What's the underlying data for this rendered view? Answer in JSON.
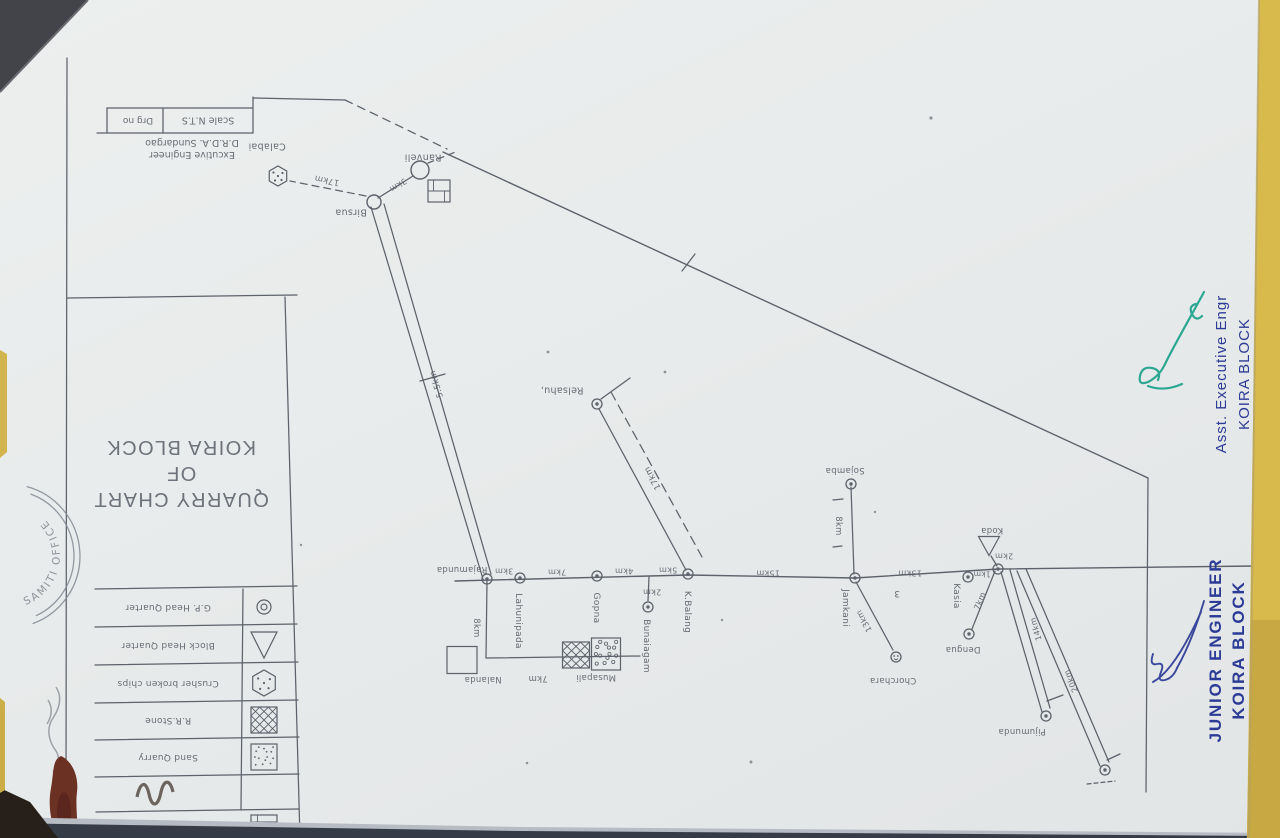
{
  "document": {
    "title_line1": "QUARRY CHART",
    "title_line2": "OF",
    "title_line3": "KOIRA BLOCK"
  },
  "title_block": {
    "scale": "Scale N.T.S",
    "drg_no": "Drg no",
    "engineer_line1": "Excutive Engineer",
    "engineer_line2": "D.R.D.A. Sundargao"
  },
  "signatures": {
    "asst_title": "Asst. Executive Engr",
    "asst_org": "KOIRA BLOCK",
    "junior_title": "JUNIOR ENGINEER",
    "junior_org": "KOIRA BLOCK"
  },
  "stamp": {
    "text": "SAMITI OFFICE"
  },
  "colors": {
    "pencil": "#5d626b",
    "blue_ink": "#2c3b96",
    "green_ink": "#17a089",
    "paper": "#e8ebeb",
    "background_yellow": "#d7b94c"
  },
  "legend": {
    "rows": [
      {
        "label": "G.P. Head Quarter",
        "symbol": "ring"
      },
      {
        "label": "Block Head Quarter",
        "symbol": "tri"
      },
      {
        "label": "Crusher broken chips",
        "symbol": "hex"
      },
      {
        "label": "R.R.Stone",
        "symbol": "hatch"
      },
      {
        "label": "Sand Quarry",
        "symbol": "stip"
      },
      {
        "label": "",
        "symbol": "brick"
      }
    ]
  },
  "drawing": {
    "edges": [
      {
        "n": "titleblock-top",
        "pts": [
          [
            107,
            108
          ],
          [
            253,
            108
          ]
        ]
      },
      {
        "n": "titleblock-bottom",
        "pts": [
          [
            97,
            133
          ],
          [
            253,
            133
          ]
        ]
      },
      {
        "n": "titleblock-left-divider",
        "pts": [
          [
            107,
            108
          ],
          [
            107,
            133
          ]
        ]
      },
      {
        "n": "titleblock-divider",
        "pts": [
          [
            163,
            108
          ],
          [
            163,
            133
          ]
        ]
      },
      {
        "n": "titleblock-right",
        "pts": [
          [
            253,
            97
          ],
          [
            253,
            133
          ]
        ]
      },
      {
        "n": "titleblock-topline",
        "pts": [
          [
            253,
            98
          ],
          [
            345,
            100
          ]
        ]
      },
      {
        "n": "leader-dashed",
        "pts": [
          [
            345,
            100
          ],
          [
            447,
            149
          ]
        ],
        "dash": "8 6"
      },
      {
        "n": "frame-left",
        "pts": [
          [
            67,
            58
          ],
          [
            66,
            795
          ]
        ]
      },
      {
        "n": "panel-top",
        "pts": [
          [
            67,
            298
          ],
          [
            297,
            295
          ]
        ]
      },
      {
        "n": "panel-right",
        "pts": [
          [
            285,
            297
          ],
          [
            300,
            838
          ]
        ]
      },
      {
        "n": "legend-line",
        "pts": [
          [
            95,
            589
          ],
          [
            297,
            586
          ]
        ]
      },
      {
        "n": "legend-line",
        "pts": [
          [
            95,
            627
          ],
          [
            297,
            624
          ]
        ]
      },
      {
        "n": "legend-line",
        "pts": [
          [
            95,
            665
          ],
          [
            298,
            662
          ]
        ]
      },
      {
        "n": "legend-line",
        "pts": [
          [
            95,
            703
          ],
          [
            298,
            700
          ]
        ]
      },
      {
        "n": "legend-line",
        "pts": [
          [
            95,
            740
          ],
          [
            299,
            737
          ]
        ]
      },
      {
        "n": "legend-line",
        "pts": [
          [
            95,
            777
          ],
          [
            299,
            774
          ]
        ]
      },
      {
        "n": "legend-line",
        "pts": [
          [
            96,
            812
          ],
          [
            299,
            809
          ]
        ]
      },
      {
        "n": "legend-divider",
        "pts": [
          [
            243,
            589
          ],
          [
            241,
            810
          ]
        ]
      },
      {
        "n": "road-main",
        "pts": [
          [
            455,
            581
          ],
          [
            688,
            575
          ],
          [
            855,
            578
          ],
          [
            998,
            569
          ],
          [
            1256,
            566
          ]
        ],
        "w": 1.4
      },
      {
        "n": "road-rajamunda-south",
        "pts": [
          [
            487,
            581
          ],
          [
            486,
            658
          ]
        ]
      },
      {
        "n": "road-bottom",
        "pts": [
          [
            486,
            658
          ],
          [
            640,
            656
          ]
        ]
      },
      {
        "n": "road-branch-bunaiagam",
        "pts": [
          [
            649,
            577
          ],
          [
            648,
            601
          ]
        ]
      },
      {
        "n": "road-kbalang-relsahu",
        "pts": [
          [
            686,
            570
          ],
          [
            599,
            409
          ]
        ]
      },
      {
        "n": "trail-relsahu-dashed",
        "pts": [
          [
            611,
            392
          ],
          [
            702,
            557
          ]
        ],
        "dash": "9 6"
      },
      {
        "n": "relsahu-tick",
        "pts": [
          [
            601,
            399
          ],
          [
            630,
            378
          ]
        ]
      },
      {
        "n": "road-birsua-ranveli",
        "pts": [
          [
            378,
            198
          ],
          [
            413,
            176
          ]
        ]
      },
      {
        "n": "trail-ranveli-dashed",
        "pts": [
          [
            428,
            163
          ],
          [
            458,
            151
          ]
        ],
        "dash": "6 5"
      },
      {
        "n": "trail-calabai-dashed",
        "pts": [
          [
            366,
            196
          ],
          [
            290,
            181
          ]
        ],
        "dash": "7 5"
      },
      {
        "n": "road-pair-a",
        "pts": [
          [
            371,
            207
          ],
          [
            483,
            579
          ]
        ]
      },
      {
        "n": "road-pair-b",
        "pts": [
          [
            384,
            204
          ],
          [
            491,
            574
          ]
        ]
      },
      {
        "n": "road-pair-tick",
        "pts": [
          [
            420,
            381
          ],
          [
            445,
            374
          ]
        ]
      },
      {
        "n": "boundary-diagonal",
        "pts": [
          [
            443,
            152
          ],
          [
            1148,
            478
          ]
        ],
        "w": 1.4
      },
      {
        "n": "boundary-tick",
        "pts": [
          [
            682,
            271
          ],
          [
            695,
            254
          ]
        ]
      },
      {
        "n": "frame-right",
        "pts": [
          [
            1148,
            478
          ],
          [
            1146,
            792
          ]
        ]
      },
      {
        "n": "road-sojamba",
        "pts": [
          [
            851,
            487
          ],
          [
            854,
            574
          ]
        ]
      },
      {
        "n": "sojamba-dash",
        "pts": [
          [
            833,
            500
          ],
          [
            843,
            499
          ]
        ]
      },
      {
        "n": "sojamba-dash",
        "pts": [
          [
            833,
            547
          ],
          [
            842,
            546
          ]
        ]
      },
      {
        "n": "road-jamkani-chorchara",
        "pts": [
          [
            856,
            582
          ],
          [
            893,
            650
          ]
        ]
      },
      {
        "n": "koida-link",
        "pts": [
          [
            991,
            556
          ],
          [
            997,
            566
          ]
        ]
      },
      {
        "n": "road-koida-dengua",
        "pts": [
          [
            995,
            571
          ],
          [
            972,
            629
          ]
        ]
      },
      {
        "n": "road-koida-pijumunda-a",
        "pts": [
          [
            1001,
            572
          ],
          [
            1042,
            712
          ]
        ]
      },
      {
        "n": "road-koida-pijumunda-b",
        "pts": [
          [
            1010,
            570
          ],
          [
            1050,
            708
          ]
        ]
      },
      {
        "n": "pijumunda-tick",
        "pts": [
          [
            1047,
            701
          ],
          [
            1063,
            695
          ]
        ]
      },
      {
        "n": "road-koida-south-a",
        "pts": [
          [
            1017,
            571
          ],
          [
            1100,
            766
          ]
        ]
      },
      {
        "n": "road-koida-south-b",
        "pts": [
          [
            1026,
            569
          ],
          [
            1109,
            762
          ]
        ]
      },
      {
        "n": "terminal-tick",
        "pts": [
          [
            1107,
            760
          ],
          [
            1120,
            754
          ]
        ]
      },
      {
        "n": "terminal-dash",
        "pts": [
          [
            1087,
            784
          ],
          [
            1115,
            781
          ]
        ],
        "dash": "4 3"
      }
    ],
    "nodes": [
      {
        "id": "rajamunda",
        "x": 487,
        "y": 579,
        "t": "double"
      },
      {
        "id": "lahunipada",
        "x": 520,
        "y": 578,
        "t": "double"
      },
      {
        "id": "gopna",
        "x": 597,
        "y": 576,
        "t": "double"
      },
      {
        "id": "bunaiagam",
        "x": 648,
        "y": 607,
        "t": "double"
      },
      {
        "id": "kbalang",
        "x": 688,
        "y": 574,
        "t": "double"
      },
      {
        "id": "relsahu",
        "x": 597,
        "y": 404,
        "t": "double"
      },
      {
        "id": "sojamba",
        "x": 851,
        "y": 484,
        "t": "double"
      },
      {
        "id": "jamkani",
        "x": 855,
        "y": 578,
        "t": "double"
      },
      {
        "id": "chorchara",
        "x": 896,
        "y": 657,
        "t": "dots"
      },
      {
        "id": "kasia",
        "x": 968,
        "y": 577,
        "t": "double"
      },
      {
        "id": "koida-junction",
        "x": 998,
        "y": 569,
        "t": "double"
      },
      {
        "id": "dengua",
        "x": 969,
        "y": 634,
        "t": "double"
      },
      {
        "id": "pijumunda",
        "x": 1046,
        "y": 716,
        "t": "double"
      },
      {
        "id": "terminal-20km",
        "x": 1105,
        "y": 770,
        "t": "double"
      },
      {
        "id": "ranveli",
        "x": 420,
        "y": 170,
        "t": "circle",
        "r": 9
      },
      {
        "id": "birsua",
        "x": 374,
        "y": 202,
        "t": "circle",
        "r": 7
      }
    ],
    "symbols": [
      {
        "t": "brick",
        "x": 439,
        "y": 191,
        "w": 22,
        "h": 22,
        "n": "quarry-symbol-ranveli"
      },
      {
        "t": "hex",
        "x": 278,
        "y": 176,
        "w": 20,
        "n": "crusher-symbol-calabai"
      },
      {
        "t": "tri",
        "x": 989,
        "y": 546,
        "w": 21,
        "h": 19,
        "n": "block-hq-symbol-koida"
      },
      {
        "t": "rect",
        "x": 462,
        "y": 660,
        "w": 30,
        "h": 27,
        "n": "quarry-square-nalanda"
      },
      {
        "t": "hatch",
        "x": 576,
        "y": 655,
        "w": 27,
        "h": 26,
        "n": "rrstone-symbol-musapali"
      },
      {
        "t": "stipc",
        "x": 606,
        "y": 654,
        "w": 29,
        "h": 32,
        "n": "sand-symbol-musapali"
      }
    ],
    "labels": [
      {
        "t": "Calabai",
        "x": 267,
        "y": 146,
        "n": "village-calabai"
      },
      {
        "t": "Ranveli",
        "x": 423,
        "y": 157,
        "n": "village-ranveli"
      },
      {
        "t": "Birsua",
        "x": 351,
        "y": 212,
        "n": "village-birsua"
      },
      {
        "t": "Relsahu,",
        "x": 562,
        "y": 390,
        "n": "village-relsahu"
      },
      {
        "t": "Rajamunda",
        "x": 462,
        "y": 569,
        "fs": 8.5,
        "n": "village-rajamunda"
      },
      {
        "t": "Lahunipada",
        "x": 518,
        "y": 621,
        "rot": 90,
        "fs": 9,
        "n": "village-lahunipada"
      },
      {
        "t": "Gopna",
        "x": 596,
        "y": 608,
        "rot": 90,
        "fs": 9,
        "n": "village-gopna"
      },
      {
        "t": "Bunaiagam",
        "x": 646,
        "y": 646,
        "rot": 90,
        "fs": 9,
        "n": "village-bunaiagam"
      },
      {
        "t": "K.Balang",
        "x": 687,
        "y": 612,
        "rot": 90,
        "fs": 9,
        "n": "village-kbalang"
      },
      {
        "t": "Sojamba",
        "x": 845,
        "y": 470,
        "fs": 8.5,
        "n": "village-sojamba"
      },
      {
        "t": "Jamkani",
        "x": 845,
        "y": 608,
        "rot": 90,
        "fs": 9,
        "n": "village-jamkani"
      },
      {
        "t": "Chorchara",
        "x": 893,
        "y": 680,
        "fs": 8.5,
        "n": "village-chorchara"
      },
      {
        "t": "Kasia",
        "x": 956,
        "y": 596,
        "rot": 90,
        "fs": 9,
        "n": "village-kasia"
      },
      {
        "t": "Koda",
        "x": 992,
        "y": 530,
        "fs": 8.5,
        "n": "village-koda"
      },
      {
        "t": "Dengua",
        "x": 963,
        "y": 649,
        "fs": 8.5,
        "n": "village-dengua"
      },
      {
        "t": "Pijumunda",
        "x": 1022,
        "y": 731,
        "fs": 8.5,
        "n": "village-pijumunda"
      },
      {
        "t": "Nalanda",
        "x": 483,
        "y": 679,
        "fs": 8.5,
        "n": "village-nalanda"
      },
      {
        "t": "Musapali",
        "x": 596,
        "y": 677,
        "fs": 8.5,
        "n": "village-musapali"
      },
      {
        "t": "17km",
        "x": 327,
        "y": 180,
        "rot": 192,
        "fs": 8.5
      },
      {
        "t": "3km",
        "x": 398,
        "y": 185,
        "rot": 148,
        "fs": 8
      },
      {
        "t": "5.5km",
        "x": 437,
        "y": 384,
        "rot": 253,
        "fs": 8.5
      },
      {
        "t": "3km",
        "x": 504,
        "y": 571,
        "fs": 8
      },
      {
        "t": "7km",
        "x": 557,
        "y": 572,
        "fs": 8
      },
      {
        "t": "4km",
        "x": 624,
        "y": 571,
        "fs": 8
      },
      {
        "t": "2km",
        "x": 652,
        "y": 592,
        "fs": 8
      },
      {
        "t": "5km",
        "x": 668,
        "y": 570,
        "fs": 8
      },
      {
        "t": "8km",
        "x": 476,
        "y": 628,
        "rot": 90,
        "fs": 8.5
      },
      {
        "t": "17km",
        "x": 653,
        "y": 478,
        "rot": 241,
        "fs": 8.5
      },
      {
        "t": "15km",
        "x": 768,
        "y": 573,
        "fs": 8
      },
      {
        "t": "8km",
        "x": 838,
        "y": 526,
        "rot": 90,
        "fs": 8.5
      },
      {
        "t": "13km",
        "x": 864,
        "y": 621,
        "rot": 241,
        "fs": 8
      },
      {
        "t": "13km",
        "x": 910,
        "y": 573,
        "fs": 8
      },
      {
        "t": "1km",
        "x": 982,
        "y": 574,
        "fs": 7.5
      },
      {
        "t": "2km",
        "x": 1004,
        "y": 556,
        "fs": 8
      },
      {
        "t": "7km",
        "x": 980,
        "y": 601,
        "rot": 292,
        "fs": 8
      },
      {
        "t": "14km",
        "x": 1036,
        "y": 629,
        "rot": 254,
        "fs": 8
      },
      {
        "t": "20km",
        "x": 1071,
        "y": 681,
        "rot": 247,
        "fs": 8
      },
      {
        "t": "7km",
        "x": 538,
        "y": 678,
        "fs": 8.5
      },
      {
        "t": "3",
        "x": 897,
        "y": 593,
        "fs": 9,
        "n": "stray-mark-3"
      }
    ]
  }
}
